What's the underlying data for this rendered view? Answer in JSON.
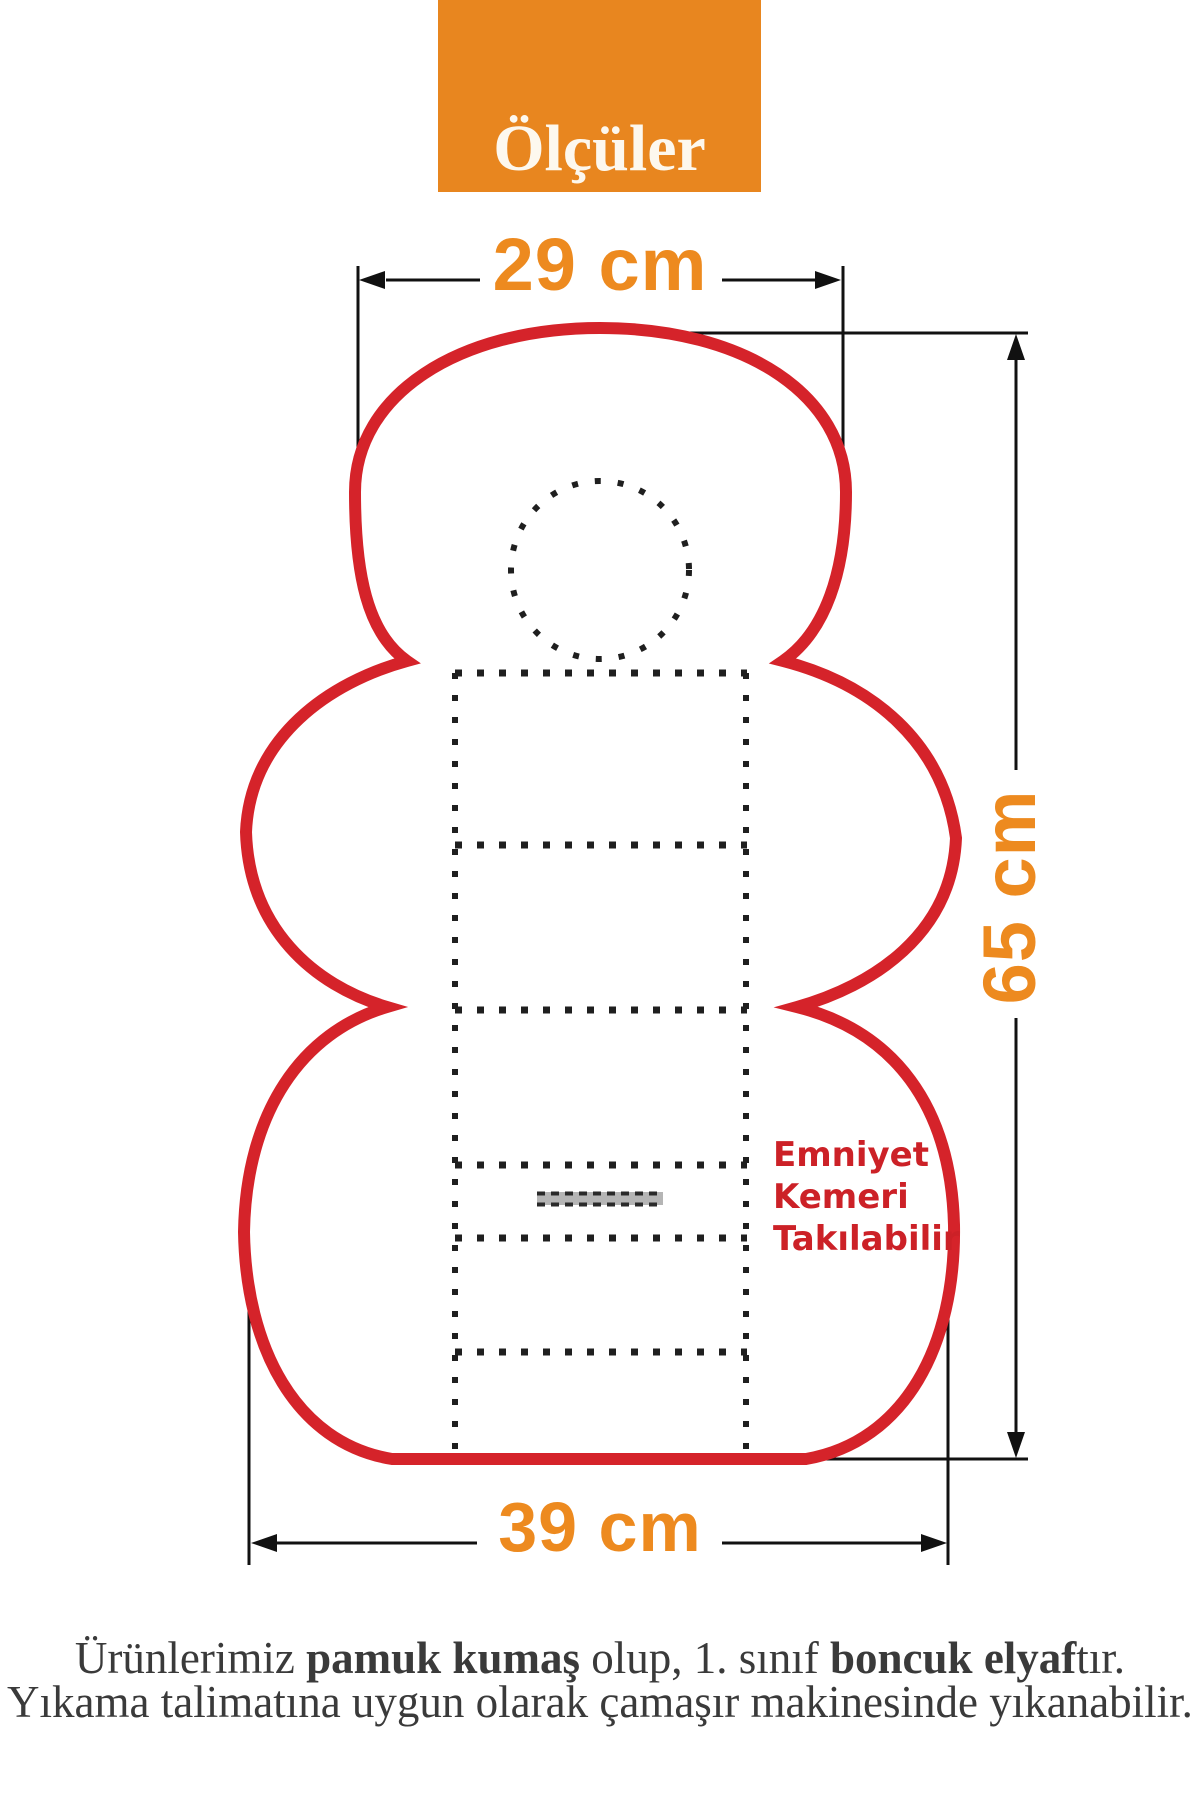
{
  "header": {
    "title": "Ölçüler"
  },
  "dimensions": {
    "top_width": "29 cm",
    "side_height": "65 cm",
    "bottom_width": "39 cm"
  },
  "belt_note": {
    "lines": [
      "Emniyet",
      "Kemeri",
      "Takılabilir"
    ]
  },
  "footer": {
    "l1a": "Ürünlerimiz ",
    "l1b": "pamuk kumaş",
    "l1c": " olup, 1. sınıf ",
    "l1d": "boncuk elyaf",
    "l1e": "tır.",
    "l2": "Yıkama talimatına uygun olarak çamaşır makinesinde yıkanabilir."
  },
  "colors": {
    "header_bg": "#e8861f",
    "accent_orange": "#ed8a1f",
    "outline_red": "#d5232a",
    "note_red": "#cc2127",
    "stitch_black": "#1f1f1f",
    "belt_slot_gray": "#b5b5b5",
    "dimension_line_black": "#111111",
    "footer_text": "#3a3a3a"
  }
}
